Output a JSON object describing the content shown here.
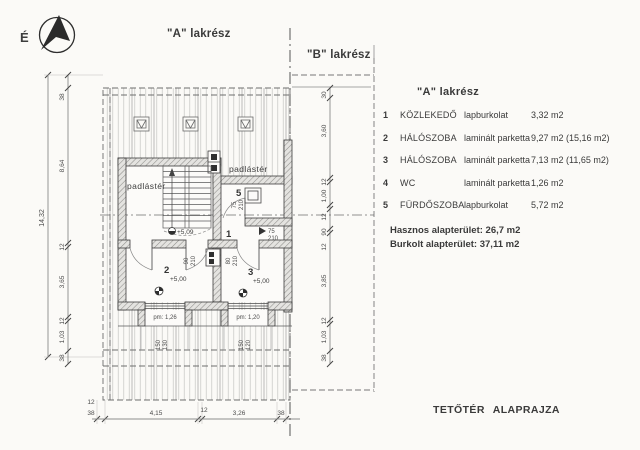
{
  "north_label": "É",
  "unit_a_label": "\"A\" lakrész",
  "unit_b_label": "\"B\" lakrész",
  "legend": {
    "title": "\"A\" lakrész",
    "rows": [
      {
        "num": "1",
        "name": "KÖZLEKEDŐ",
        "finish": "lapburkolat",
        "area": "3,32 m2"
      },
      {
        "num": "2",
        "name": "HÁLÓSZOBA",
        "finish": "laminált parketta",
        "area": "9,27 m2 (15,16 m2)"
      },
      {
        "num": "3",
        "name": "HÁLÓSZOBA",
        "finish": "laminált parketta",
        "area": "7,13 m2 (11,65 m2)"
      },
      {
        "num": "4",
        "name": "WC",
        "finish": "laminált parketta",
        "area": "1,26 m2"
      },
      {
        "num": "5",
        "name": "FÜRDŐSZOBA",
        "finish": "lapburkolat",
        "area": "5,72 m2"
      }
    ],
    "total_useful": "Hasznos alapterület: 26,7 m2",
    "total_covered": "Burkolt alapterület: 37,11 m2"
  },
  "drawing_title": "TETŐTÉR ALAPRAJZA",
  "plan": {
    "attic_label_left": "padlástér",
    "attic_label_right": "padlástér",
    "room1_num": "1",
    "room2_num": "2",
    "room3_num": "3",
    "room5_num": "5",
    "level_stair": "+5,09",
    "level_room2": "+5,00",
    "level_room3": "+5,00",
    "door_room5_w": "75",
    "door_room5_h": "210",
    "door_hall_w": "75",
    "door_hall_h": "210",
    "door_room2_w": "90",
    "door_room2_h": "210",
    "door_room3_w": "80",
    "door_room3_h": "210",
    "parapet_left": "pm: 1,26",
    "parapet_right": "pm: 1,20",
    "window_left_w": "150",
    "window_left_h": "130",
    "window_right_w": "150",
    "window_right_h": "120"
  },
  "dims": {
    "left_total": "14,32",
    "left_chain": [
      "38",
      "8,64",
      "12",
      "3,65",
      "12",
      "1,03",
      "38"
    ],
    "right_chain": [
      "30",
      "3,60",
      "12",
      "1,00",
      "12",
      "90",
      "12",
      "3,85",
      "12",
      "1,03",
      "38"
    ],
    "bottom_chain": [
      "38",
      "4,15",
      "12",
      "3,26",
      "38"
    ],
    "bottom_eave": "12"
  }
}
